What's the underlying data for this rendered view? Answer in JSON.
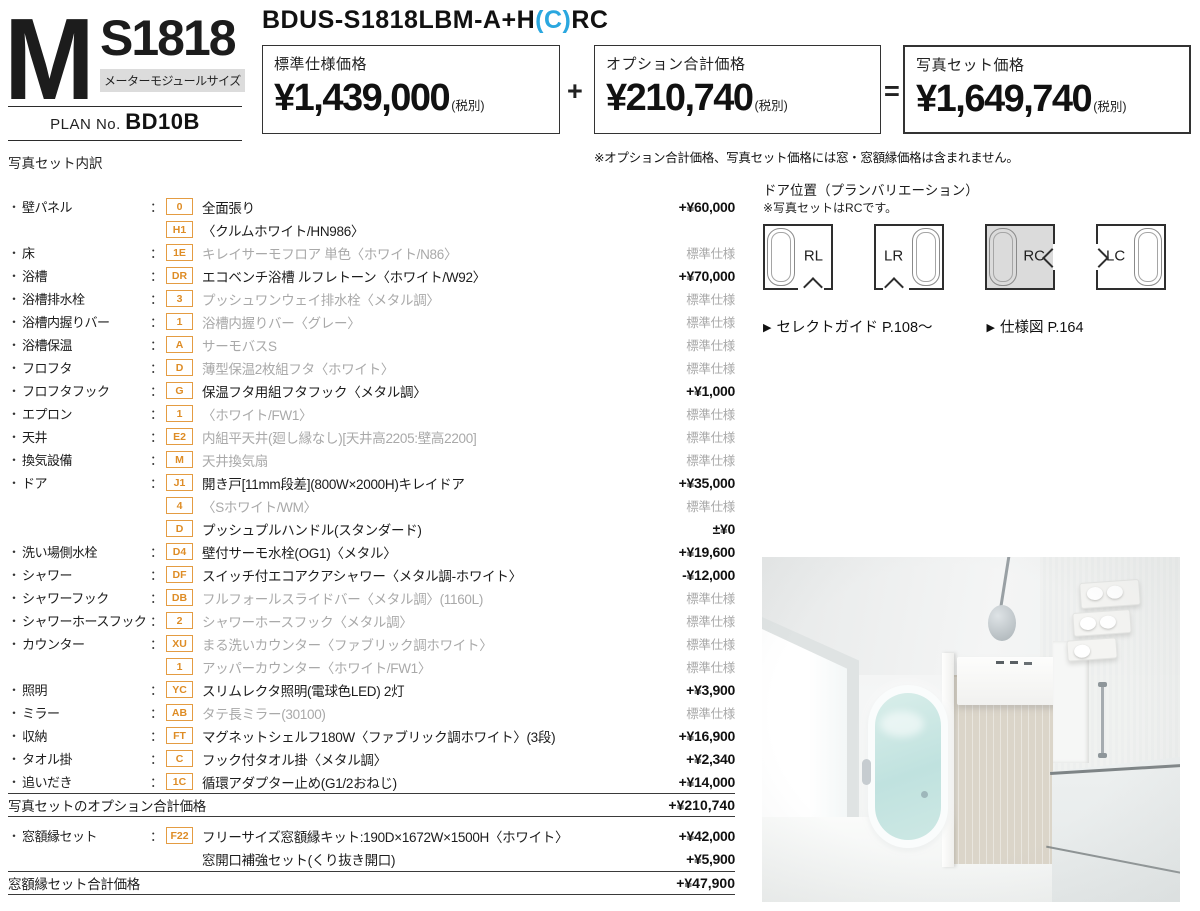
{
  "header": {
    "logo": {
      "m": "M",
      "model": "S1818",
      "badge": "メーターモジュールサイズ",
      "plan_label": "PLAN No.",
      "plan_no": "BD10B"
    },
    "product_code": {
      "pre": "BDUS-S1818LBM-A+H",
      "highlight": "(C)",
      "post": "RC"
    },
    "price_boxes": [
      {
        "label": "標準仕様価格",
        "amount": "¥1,439,000",
        "tax": "(税別)"
      },
      {
        "label": "オプション合計価格",
        "amount": "¥210,740",
        "tax": "(税別)"
      },
      {
        "label": "写真セット価格",
        "amount": "¥1,649,740",
        "tax": "(税別)"
      }
    ],
    "operators": {
      "plus": "+",
      "equals": "="
    },
    "note": "※オプション合計価格、写真セット価格には窓・窓額縁価格は含まれません。"
  },
  "breakdown": {
    "title": "写真セット内訳",
    "bullet": "・",
    "colon": "：",
    "standard_label": "標準仕様",
    "rows": [
      {
        "category": "壁パネル",
        "code": "0",
        "desc": "全面張り",
        "price": "+¥60,000",
        "muted": false
      },
      {
        "category": "",
        "code": "H1",
        "desc": "〈クルムホワイト/HN986〉",
        "price": "",
        "muted": false
      },
      {
        "category": "床",
        "code": "1E",
        "desc": "キレイサーモフロア 単色〈ホワイト/N86〉",
        "price": "標準仕様",
        "muted": true
      },
      {
        "category": "浴槽",
        "code": "DR",
        "desc": "エコベンチ浴槽 ルフレトーン〈ホワイト/W92〉",
        "price": "+¥70,000",
        "muted": false
      },
      {
        "category": "浴槽排水栓",
        "code": "3",
        "desc": "プッシュワンウェイ排水栓〈メタル調〉",
        "price": "標準仕様",
        "muted": true
      },
      {
        "category": "浴槽内握りバー",
        "code": "1",
        "desc": "浴槽内握りバー〈グレー〉",
        "price": "標準仕様",
        "muted": true
      },
      {
        "category": "浴槽保温",
        "code": "A",
        "desc": "サーモバスS",
        "price": "標準仕様",
        "muted": true
      },
      {
        "category": "フロフタ",
        "code": "D",
        "desc": "薄型保温2枚組フタ〈ホワイト〉",
        "price": "標準仕様",
        "muted": true
      },
      {
        "category": "フロフタフック",
        "code": "G",
        "desc": "保温フタ用組フタフック〈メタル調〉",
        "price": "+¥1,000",
        "muted": false
      },
      {
        "category": "エプロン",
        "code": "1",
        "desc": "〈ホワイト/FW1〉",
        "price": "標準仕様",
        "muted": true
      },
      {
        "category": "天井",
        "code": "E2",
        "desc": "内組平天井(廻し縁なし)[天井高2205:壁高2200]",
        "price": "標準仕様",
        "muted": true
      },
      {
        "category": "換気設備",
        "code": "M",
        "desc": "天井換気扇",
        "price": "標準仕様",
        "muted": true
      },
      {
        "category": "ドア",
        "code": "J1",
        "desc": "開き戸[11mm段差](800W×2000H)キレイドア",
        "price": "+¥35,000",
        "muted": false
      },
      {
        "category": "",
        "code": "4",
        "desc": "〈Sホワイト/WM〉",
        "price": "標準仕様",
        "muted": true
      },
      {
        "category": "",
        "code": "D",
        "desc": "プッシュプルハンドル(スタンダード)",
        "price": "±¥0",
        "muted": false
      },
      {
        "category": "洗い場側水栓",
        "code": "D4",
        "desc": "壁付サーモ水栓(OG1)〈メタル〉",
        "price": "+¥19,600",
        "muted": false
      },
      {
        "category": "シャワー",
        "code": "DF",
        "desc": "スイッチ付エコアクアシャワー〈メタル調-ホワイト〉",
        "price": "-¥12,000",
        "muted": false
      },
      {
        "category": "シャワーフック",
        "code": "DB",
        "desc": "フルフォールスライドバー〈メタル調〉(1160L)",
        "price": "標準仕様",
        "muted": true
      },
      {
        "category": "シャワーホースフック",
        "code": "2",
        "desc": "シャワーホースフック〈メタル調〉",
        "price": "標準仕様",
        "muted": true
      },
      {
        "category": "カウンター",
        "code": "XU",
        "desc": "まる洗いカウンター〈ファブリック調ホワイト〉",
        "price": "標準仕様",
        "muted": true
      },
      {
        "category": "",
        "code": "1",
        "desc": "アッパーカウンター〈ホワイト/FW1〉",
        "price": "標準仕様",
        "muted": true
      },
      {
        "category": "照明",
        "code": "YC",
        "desc": "スリムレクタ照明(電球色LED) 2灯",
        "price": "+¥3,900",
        "muted": false
      },
      {
        "category": "ミラー",
        "code": "AB",
        "desc": "タテ長ミラー(30100)",
        "price": "標準仕様",
        "muted": true
      },
      {
        "category": "収納",
        "code": "FT",
        "desc": "マグネットシェルフ180W〈ファブリック調ホワイト〉(3段)",
        "price": "+¥16,900",
        "muted": false
      },
      {
        "category": "タオル掛",
        "code": "C",
        "desc": "フック付タオル掛〈メタル調〉",
        "price": "+¥2,340",
        "muted": false
      },
      {
        "category": "追いだき",
        "code": "1C",
        "desc": "循環アダプター止め(G1/2おねじ)",
        "price": "+¥14,000",
        "muted": false
      }
    ],
    "options_total": {
      "label": "写真セットのオプション合計価格",
      "price": "+¥210,740"
    },
    "window_rows": [
      {
        "category": "窓額縁セット",
        "code": "F22",
        "desc": "フリーサイズ窓額縁キット:190D×1672W×1500H〈ホワイト〉",
        "price": "+¥42,000",
        "muted": false
      },
      {
        "category": "",
        "code": "",
        "desc": "窓開口補強セット(くり抜き開口)",
        "price": "+¥5,900",
        "muted": false
      }
    ],
    "window_total": {
      "label": "窓額縁セット合計価格",
      "price": "+¥47,900"
    }
  },
  "door_plans": {
    "title": "ドア位置（プランバリエーション）",
    "note": "※写真セットはRCです。",
    "plans": [
      {
        "label": "RL",
        "tub": "left",
        "selected": false,
        "door": "bottom-right"
      },
      {
        "label": "LR",
        "tub": "right",
        "selected": false,
        "door": "bottom-left"
      },
      {
        "label": "RC",
        "tub": "left",
        "selected": true,
        "door": "right"
      },
      {
        "label": "LC",
        "tub": "right",
        "selected": false,
        "door": "left"
      }
    ],
    "links": [
      {
        "marker": "▶",
        "text": "セレクトガイド P.108～"
      },
      {
        "marker": "▶",
        "text": "仕様図 P.164"
      }
    ]
  },
  "colors": {
    "accent_orange": "#DE8C25",
    "muted_gray": "#A9A9A9",
    "code_cyan": "#2AA7DF",
    "badge_bg": "#DCDCDC",
    "selected_plan_bg": "#DBDBDB",
    "tub_water": "#C0E2DF"
  }
}
